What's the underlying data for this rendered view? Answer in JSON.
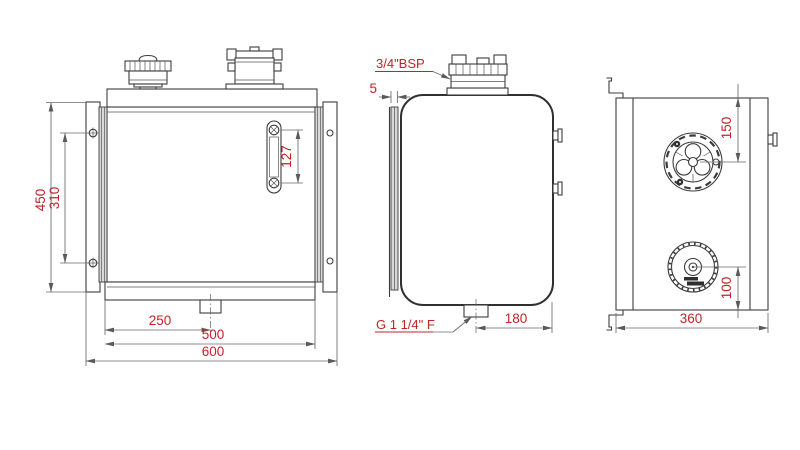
{
  "title": "hydraulic-tank-technical-drawing",
  "colors": {
    "line": "#3c3c3c",
    "dim_line": "#6a6a6a",
    "dim_text": "#c02428",
    "background": "#ffffff"
  },
  "views": {
    "front": {
      "dims": {
        "overall_height": "450",
        "hole_spacing": "310",
        "sight_glass_length": "127",
        "drain_offset": "250",
        "base_width": "500",
        "overall_width": "600"
      }
    },
    "side": {
      "labels": {
        "filler_thread": "3/4\"BSP",
        "drain_thread": "G 1 1/4\" F"
      },
      "dims": {
        "bracket_gap": "5",
        "drain_to_edge": "180"
      }
    },
    "top": {
      "dims": {
        "flange_from_top": "150",
        "cap_from_bottom": "100",
        "depth": "360"
      }
    }
  }
}
